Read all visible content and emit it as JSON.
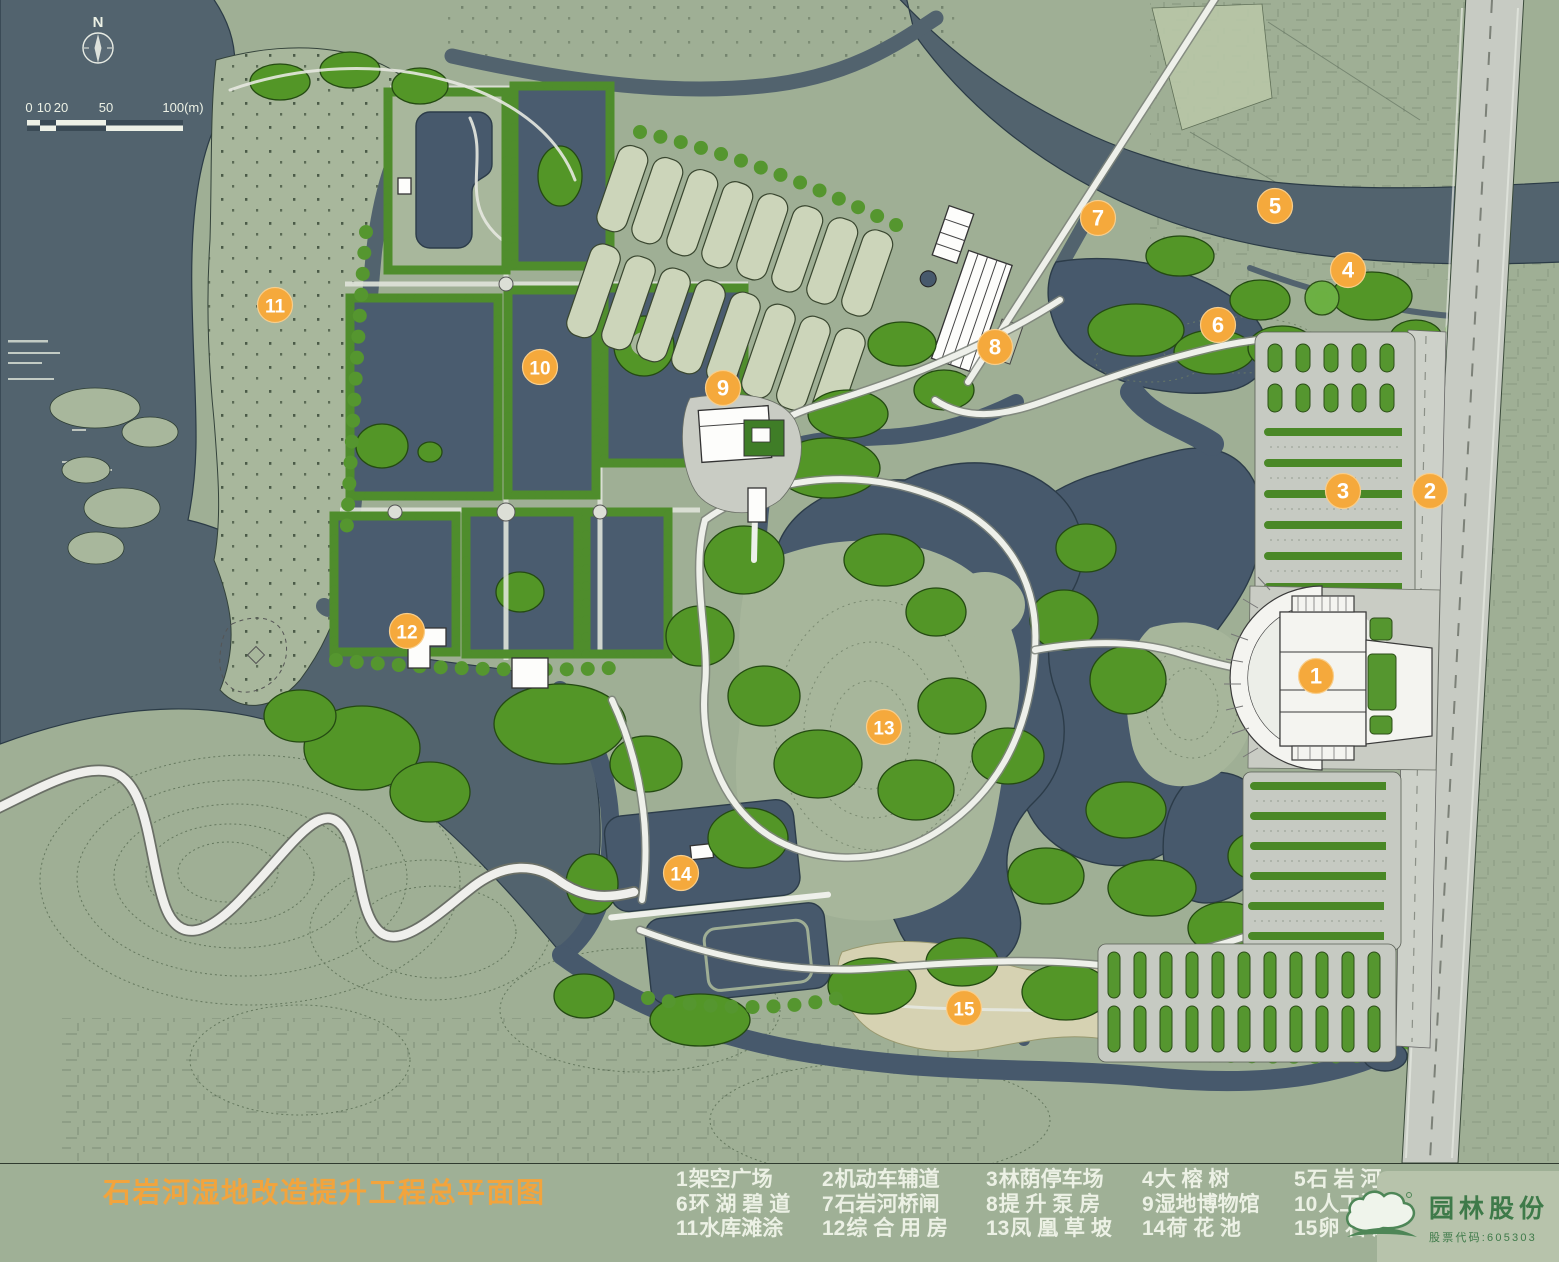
{
  "plan": {
    "title": "石岩河湿地改造提升工程总平面图"
  },
  "legend": {
    "items": [
      {
        "num": "1",
        "label": "架空广场"
      },
      {
        "num": "2",
        "label": "机动车辅道"
      },
      {
        "num": "3",
        "label": "林荫停车场"
      },
      {
        "num": "4",
        "label": "大 榕 树"
      },
      {
        "num": "5",
        "label": "石 岩 河"
      },
      {
        "num": "6",
        "label": "环 湖 碧 道"
      },
      {
        "num": "7",
        "label": "石岩河桥闸"
      },
      {
        "num": "8",
        "label": "提 升 泵 房"
      },
      {
        "num": "9",
        "label": "湿地博物馆"
      },
      {
        "num": "10",
        "label": "人工湿地"
      },
      {
        "num": "11",
        "label": "水库滩涂"
      },
      {
        "num": "12",
        "label": "综 合 用 房"
      },
      {
        "num": "13",
        "label": "凤 凰 草 坡"
      },
      {
        "num": "14",
        "label": "荷 花 池"
      },
      {
        "num": "15",
        "label": "卵 石 滩"
      }
    ]
  },
  "markers": [
    {
      "num": "1",
      "x": 1316,
      "y": 676
    },
    {
      "num": "2",
      "x": 1430,
      "y": 491
    },
    {
      "num": "3",
      "x": 1343,
      "y": 491
    },
    {
      "num": "4",
      "x": 1348,
      "y": 270
    },
    {
      "num": "5",
      "x": 1275,
      "y": 206
    },
    {
      "num": "6",
      "x": 1218,
      "y": 325
    },
    {
      "num": "7",
      "x": 1098,
      "y": 218
    },
    {
      "num": "8",
      "x": 995,
      "y": 347
    },
    {
      "num": "9",
      "x": 723,
      "y": 388
    },
    {
      "num": "10",
      "x": 540,
      "y": 367
    },
    {
      "num": "11",
      "x": 275,
      "y": 305
    },
    {
      "num": "12",
      "x": 407,
      "y": 631
    },
    {
      "num": "13",
      "x": 884,
      "y": 727
    },
    {
      "num": "14",
      "x": 681,
      "y": 873
    },
    {
      "num": "15",
      "x": 964,
      "y": 1008
    }
  ],
  "compass": {
    "north_label": "N"
  },
  "scalebar": {
    "labels": [
      "0",
      "10",
      "20",
      "50",
      "100(m)"
    ]
  },
  "logo": {
    "company": "园林股份",
    "stock_label": "股票代码:605303"
  },
  "colors": {
    "accent-orange": "#F2A43D",
    "marker-orange": "#F5A93C",
    "land-sage": "#9FAF95",
    "water-slate": "#52636E",
    "pond-blue": "#47596C",
    "tree-green": "#55962F",
    "cell-sage": "#CCD5BA",
    "road-gray": "#C7CBC3",
    "path-white": "#EEF0EA",
    "beach-tan": "#D6D2B2",
    "legend-text": "#ECF1E5",
    "logo-green": "#3E7A49"
  }
}
